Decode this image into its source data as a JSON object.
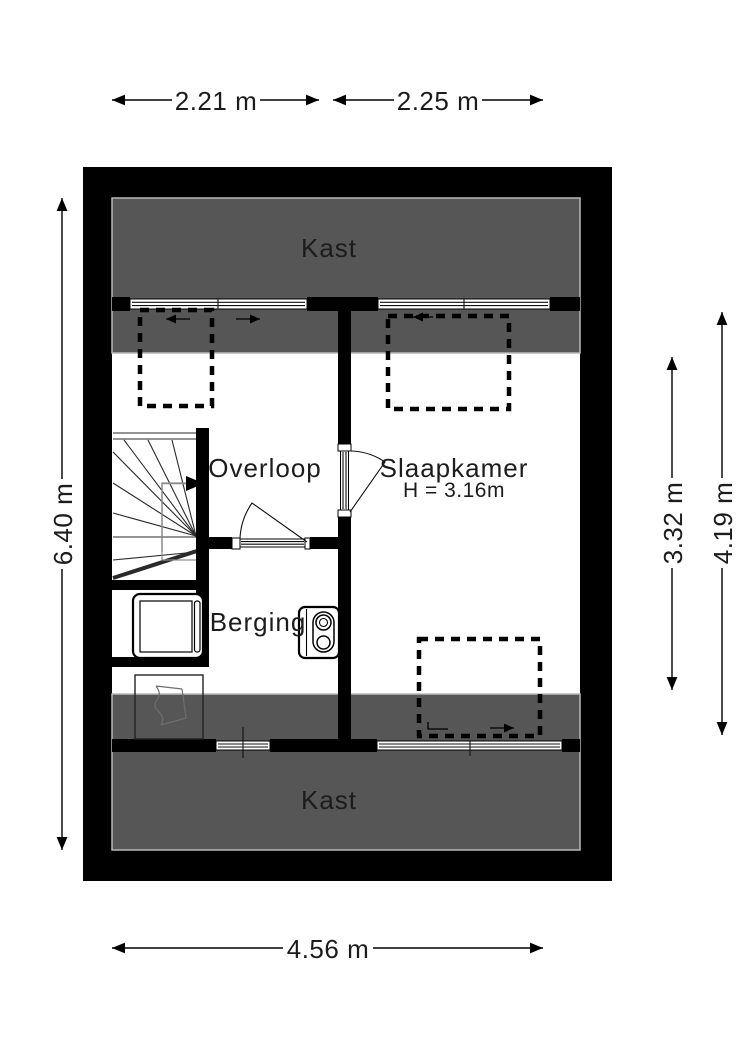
{
  "plan": {
    "type": "floor-plan",
    "floor_note": "attic floor plan with sloped-ceiling closets"
  },
  "colors": {
    "wall": "#000000",
    "low_ceiling_zone": "#565656",
    "zone_border": "#b9b9b9",
    "background": "#ffffff",
    "text": "#1c1c1c"
  },
  "rooms": {
    "kast_top": "Kast",
    "overloop": "Overloop",
    "slaapkamer": "Slaapkamer",
    "slaapkamer_height": "H = 3.16m",
    "berging": "Berging",
    "kast_bottom": "Kast"
  },
  "dimensions": {
    "top_left": "2.21 m",
    "top_right": "2.25 m",
    "left": "6.40 m",
    "right_inner": "3.32 m",
    "right_outer": "4.19 m",
    "bottom": "4.56 m"
  }
}
